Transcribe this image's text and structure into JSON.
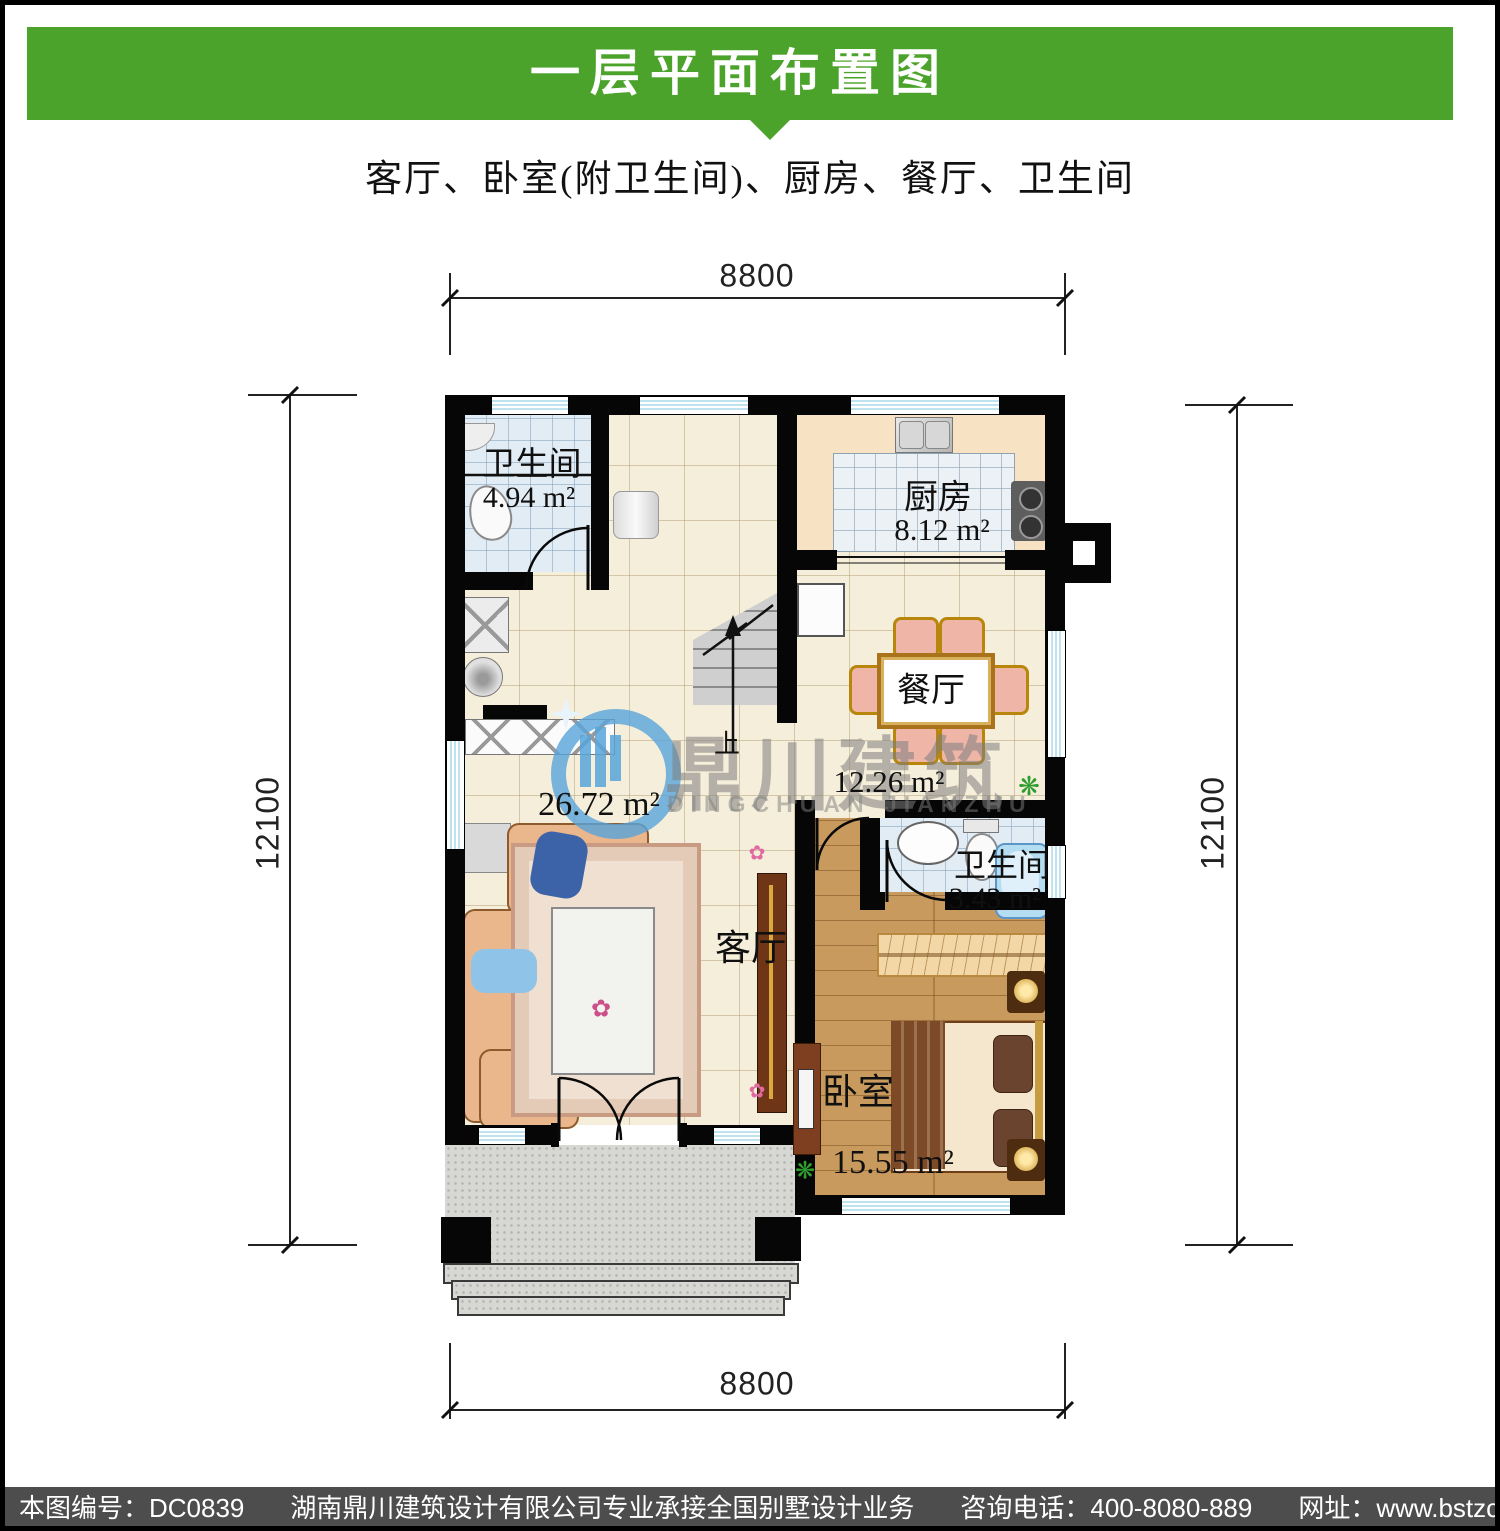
{
  "header": {
    "title": "一层平面布置图",
    "subtitle": "客厅、卧室(附卫生间)、厨房、餐厅、卫生间"
  },
  "colors": {
    "banner_green": "#4CA32B",
    "footer_gray": "#4D4D4D",
    "watermark_blue": "#57A4D9",
    "wall_black": "#060606",
    "floor_cream": "#F5EEDA",
    "tile_blue": "#E2ECF4",
    "wood_brown": "#C89A5E",
    "porch_gray": "#D7D8D4"
  },
  "dimensions": {
    "top": "8800",
    "bottom": "8800",
    "left": "12100",
    "right": "12100"
  },
  "rooms": {
    "bath1": {
      "name": "卫生间",
      "area": "4.94 m²"
    },
    "kitchen": {
      "name": "厨房",
      "area": "8.12 m²"
    },
    "dining": {
      "name": "餐厅",
      "area": "12.26 m²"
    },
    "living": {
      "name": "客厅",
      "area": "26.72 m²"
    },
    "bath2": {
      "name": "卫生间",
      "area": "3.43 m²"
    },
    "bedroom": {
      "name": "卧室",
      "area": "15.55 m²"
    }
  },
  "stairs": {
    "up_label": "上"
  },
  "watermark": {
    "brand_cn": "鼎川建筑",
    "brand_en": "DINGCHUAN JIANZHU"
  },
  "icons": {
    "plant": "❋",
    "flower": "✿"
  },
  "footer": {
    "plan_no": "本图编号：DC0839",
    "company": "湖南鼎川建筑设计有限公司专业承接全国别墅设计业务",
    "phone": "咨询电话：400-8080-889",
    "website": "网址：www.bstzcs.com"
  }
}
